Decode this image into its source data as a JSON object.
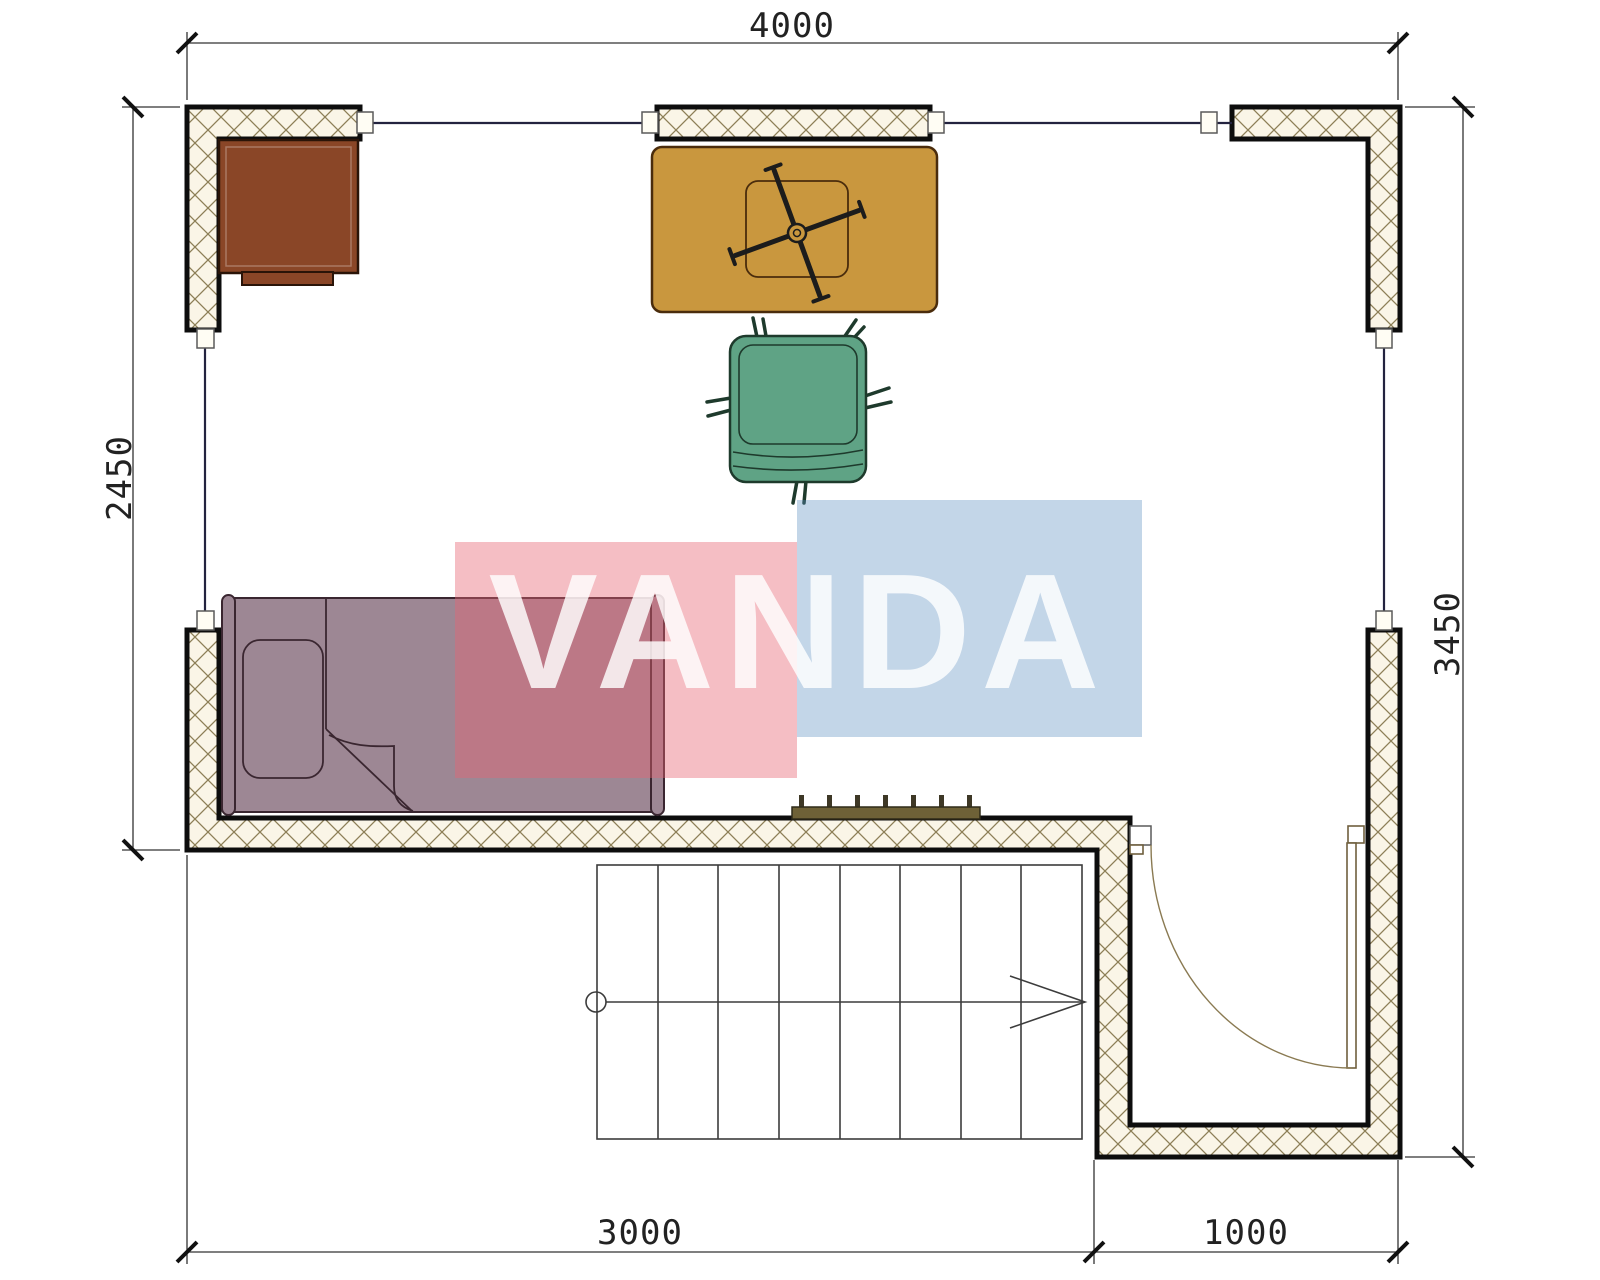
{
  "document": {
    "type": "apartment floor plan drawing"
  },
  "dimensions": {
    "top": "4000",
    "left": "2450",
    "right": "3450",
    "bottom_left": "3000",
    "bottom_right": "1000"
  },
  "watermark": {
    "text": "VANDA",
    "pink_block_color": "rgba(231,100,115,0.42)",
    "blue_block_color": "rgba(90,140,190,0.36)",
    "text_color": "rgba(255,255,255,0.82)"
  },
  "colors": {
    "wall_fill": "#faf5e7",
    "wall_hatch_line": "#8d7f57",
    "wall_outline": "#0d0d0d",
    "desk": "#8a4627",
    "table": "#c9973e",
    "chair": "#5fa385",
    "bed": "#9d8794",
    "radiator": "#6e6137",
    "radiator_fin": "#3e3826"
  }
}
